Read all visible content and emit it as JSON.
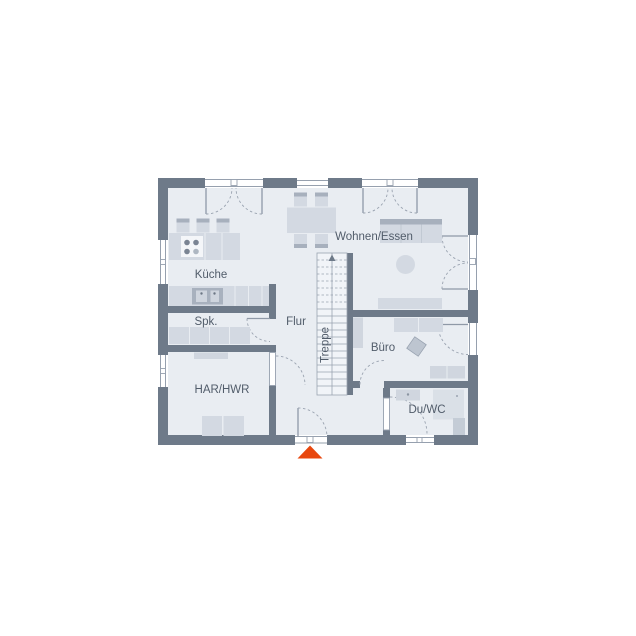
{
  "plan": {
    "type": "floor-plan-ground-floor",
    "rooms": [
      {
        "id": "kueche",
        "label": "Küche"
      },
      {
        "id": "spk",
        "label": "Spk."
      },
      {
        "id": "flur",
        "label": "Flur"
      },
      {
        "id": "har_hwr",
        "label": "HAR/HWR"
      },
      {
        "id": "wohnen_essen",
        "label": "Wohnen/Essen"
      },
      {
        "id": "buero",
        "label": "Büro"
      },
      {
        "id": "du_wc",
        "label": "Du/WC"
      },
      {
        "id": "treppe",
        "label": "Treppe"
      }
    ],
    "markers": {
      "entrance_arrow": "entrance-direction-triangle"
    },
    "palette": {
      "wall": "#6e7a89",
      "floor": "#e9edf2",
      "furniture": "#d3d9e2",
      "furniture_dark": "#a7b0bd",
      "lines": "#9aa3b0",
      "text": "#515c6a",
      "accent_arrow": "#e8470e",
      "background": "#ffffff"
    }
  }
}
